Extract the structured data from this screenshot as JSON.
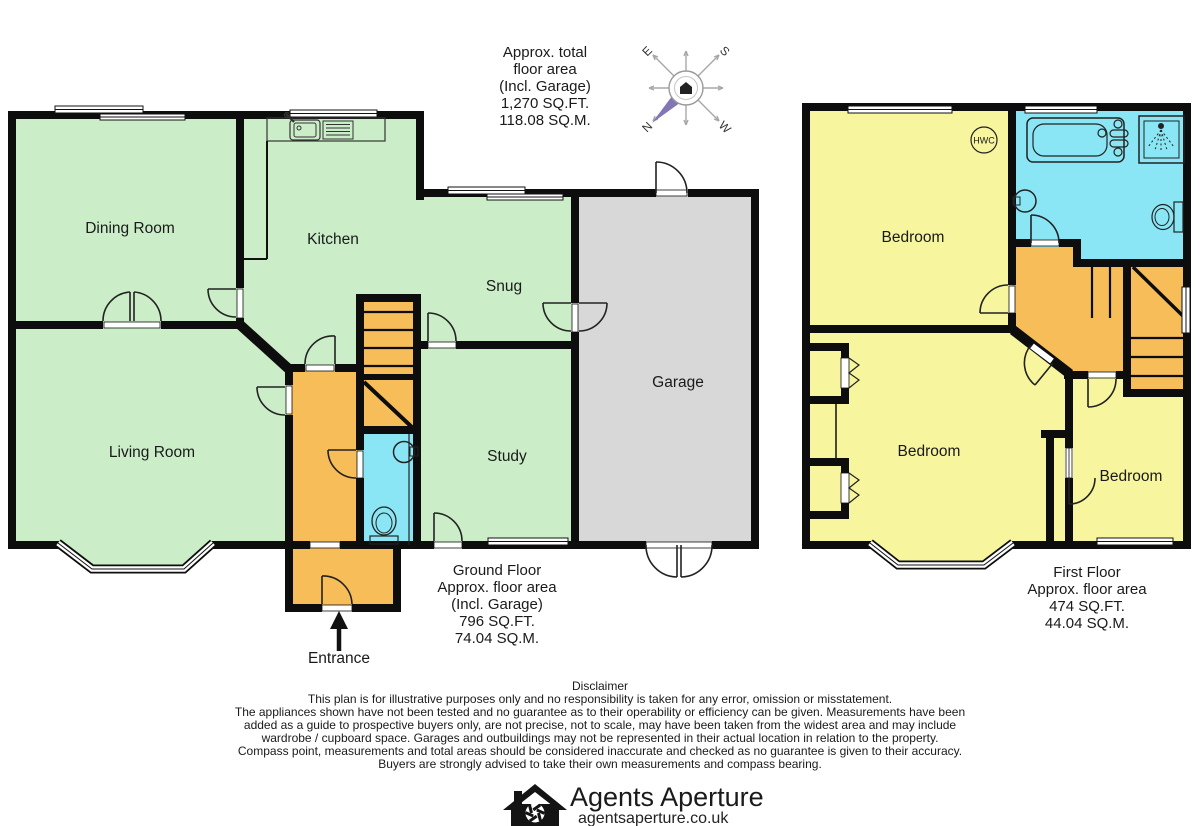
{
  "colors": {
    "room_green": "#cbeec8",
    "room_yellow": "#f7f59d",
    "room_orange": "#f6bd59",
    "room_cyan": "#8ae6f5",
    "garage_gray": "#d8d8d8",
    "wall_black": "#0d0d0d",
    "brand_purple": "#b096d6",
    "compass_purple": "#8276b4"
  },
  "total_area": {
    "lines": [
      "Approx. total",
      "floor area",
      "(Incl. Garage)",
      "1,270 SQ.FT.",
      "118.08 SQ.M."
    ]
  },
  "compass": {
    "n": "N",
    "e": "E",
    "s": "S",
    "w": "W"
  },
  "ground_floor": {
    "rooms": {
      "dining": "Dining Room",
      "kitchen": "Kitchen",
      "snug": "Snug",
      "living": "Living Room",
      "study": "Study",
      "garage": "Garage"
    },
    "entrance": "Entrance",
    "area_label": {
      "lines": [
        "Ground Floor",
        "Approx. floor area",
        "(Incl. Garage)",
        "796 SQ.FT.",
        "74.04 SQ.M."
      ]
    }
  },
  "first_floor": {
    "rooms": {
      "bedroom1": "Bedroom",
      "bedroom2": "Bedroom",
      "bedroom3": "Bedroom"
    },
    "hwc": "HWC",
    "area_label": {
      "lines": [
        "First Floor",
        "Approx. floor area",
        "474 SQ.FT.",
        "44.04 SQ.M."
      ]
    }
  },
  "disclaimer": {
    "title": "Disclaimer",
    "lines": [
      "This plan is for illustrative purposes only and no responsibility is taken for any error, omission or misstatement.",
      "The appliances shown have not been tested and no guarantee as to their operability or efficiency can be given. Measurements have been",
      "added as a guide to prospective buyers only, are not precise, not to scale, may have been taken from the widest area and may include",
      "wardrobe / cupboard space. Garages and outbuildings may not be represented in their actual location in relation to  the property.",
      "Compass point, measurements and total areas should be considered inaccurate and checked as no guarantee is given to their accuracy.",
      "Buyers are strongly advised to take their own measurements and compass bearing."
    ]
  },
  "footer": {
    "brand": "Agents Aperture",
    "url": "agentsaperture.co.uk"
  }
}
